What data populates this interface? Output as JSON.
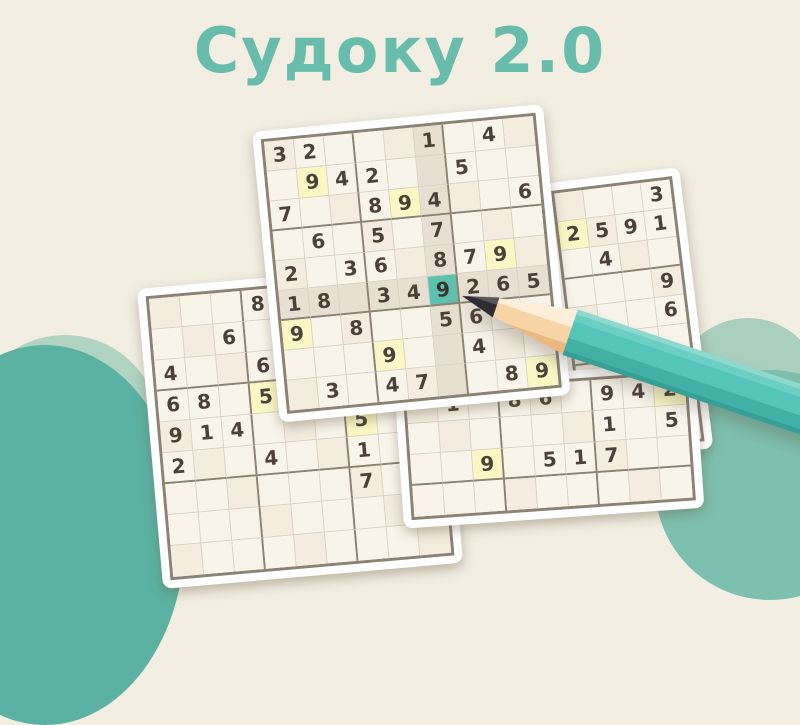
{
  "title": "Судоку 2.0",
  "colors": {
    "background": "#f2eee2",
    "title_accent": "#68bcab",
    "cell": "#f9f4ea",
    "cell_shaded": "#e8dfd3",
    "cell_same_number_highlight": "#faf7c5",
    "cell_selected": "#5ec0ae",
    "digit": "#4b4138",
    "grid_border": "#8b8274",
    "pencil_body": "#55c5ba",
    "cloud_light": "#b0d3c2",
    "cloud_dark": "#5cb2a2"
  },
  "selected_cell": {
    "value": "9",
    "row": 6,
    "col": 6
  },
  "grids": {
    "main": {
      "cols": 9,
      "rows": [
        "32...1.4.",
        ".942..5..",
        "7..894..6",
        ".6.5.7...",
        "2.36.879.",
        "18.349265",
        "9.8..56..",
        "...9..4..",
        ".3.47..89"
      ],
      "yellow": [
        [
          2,
          2
        ],
        [
          3,
          5
        ],
        [
          5,
          8
        ],
        [
          7,
          1
        ],
        [
          8,
          4
        ],
        [
          9,
          9
        ]
      ],
      "selected": [
        6,
        6
      ],
      "shaded_row": 6,
      "shaded_col": 6,
      "box_cols": [
        3,
        6
      ],
      "box_rows": [
        3,
        6
      ]
    },
    "left": {
      "cols": 9,
      "rows": [
        "...8.....",
        "..6......",
        "4..6.....",
        "68.5.....",
        "914...5..",
        "2..4..1..",
        "......7..",
        ".........",
        "........."
      ],
      "yellow": [
        [
          4,
          4
        ],
        [
          5,
          7
        ]
      ],
      "box_cols": [
        3,
        6
      ],
      "box_rows": [
        3,
        6
      ]
    },
    "right": {
      "cols": 4,
      "rows": [
        "...3",
        "2591",
        ".4..",
        "...9",
        "...6",
        "....",
        "....",
        "....",
        "...."
      ],
      "yellow": [
        [
          2,
          1
        ]
      ],
      "box_cols": [],
      "box_rows": [
        3,
        6
      ]
    },
    "bottom": {
      "cols": 9,
      "rows": [
        ".1.86.942",
        "......1.5",
        "..9.517..",
        "........."
      ],
      "yellow": [
        [
          1,
          9
        ],
        [
          3,
          3
        ]
      ],
      "box_cols": [
        3,
        6
      ],
      "box_rows": [
        3
      ]
    }
  }
}
